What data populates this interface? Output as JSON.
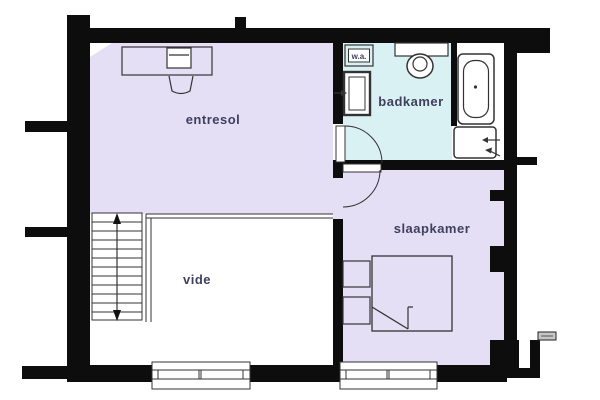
{
  "plan": {
    "type": "floor plan (upper storey)",
    "rooms": {
      "entresol": {
        "label": "entresol"
      },
      "badkamer": {
        "label": "badkamer"
      },
      "slaapkamer": {
        "label": "slaapkamer"
      },
      "vide": {
        "label": "vide"
      },
      "wa": {
        "label": "w.a."
      }
    }
  },
  "colors": {
    "wall": "#0d0d0d",
    "room_fill": "#e4dff4",
    "bath_fill": "#d9f1f3",
    "line": "#333333",
    "label_text": "#3f3f5e",
    "fixture_fill": "#ffffff"
  }
}
